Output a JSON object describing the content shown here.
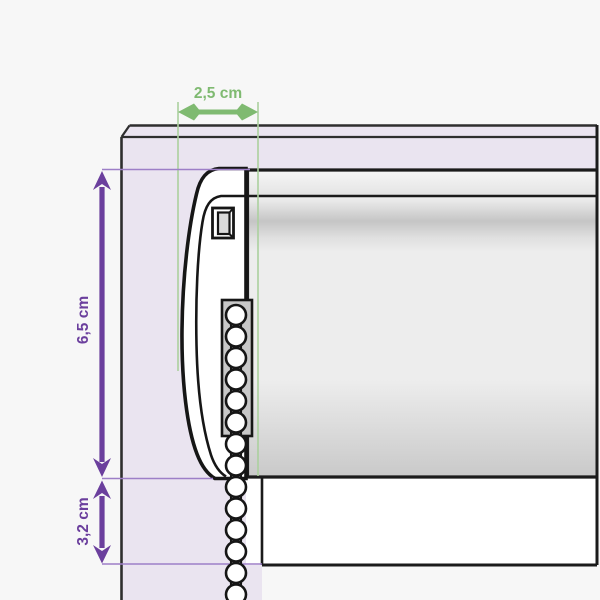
{
  "header": {
    "product_name": "Látková MAXI",
    "subtitle": "- vrtání na okno"
  },
  "dimensions": {
    "top_depth": {
      "label": "2,5 cm",
      "value_cm": 2.5,
      "orientation": "horizontal"
    },
    "side_height": {
      "label": "6,5 cm",
      "value_cm": 6.5,
      "orientation": "vertical"
    },
    "bottom_offset": {
      "label": "3,2 cm",
      "value_cm": 3.2,
      "orientation": "vertical"
    }
  },
  "diagram": {
    "parts": {
      "window_frame": "okenní rám",
      "blind_cassette": "roleta - horní profil",
      "fabric": "látka rolety",
      "side_bracket": "boční kryt / držák",
      "chain_housing": "vedení řetízku",
      "chain": "ovládací řetízek",
      "sill": "spodní lišta okna"
    }
  },
  "colors": {
    "background": "#F7F7F7",
    "frame_fill": "#EAE4F0",
    "outline": "#1B1B1B",
    "frame_outline": "#2E2E2E",
    "dimension_purple": "#6B3F9D",
    "dimension_purple_light": "#9D7FC7",
    "dimension_green": "#7FBA71",
    "dimension_green_light": "#ABD09E",
    "fabric_fill": "#EDEDED",
    "chain_housing_fill": "#C8C8C8",
    "sill_fill": "#FFFFFF"
  }
}
